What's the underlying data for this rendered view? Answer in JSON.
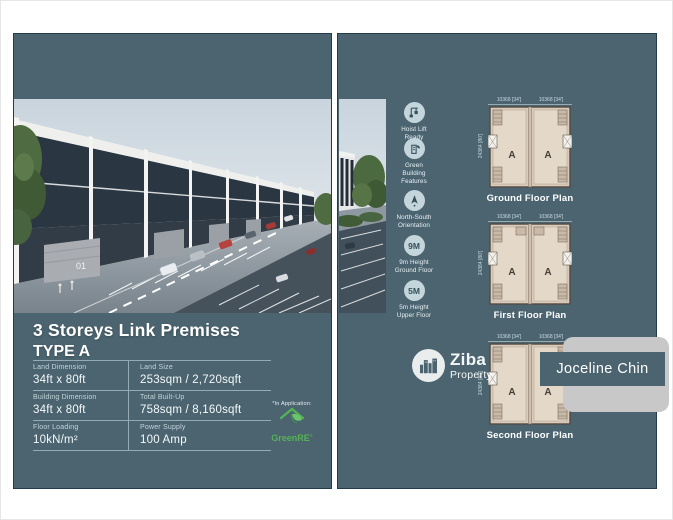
{
  "colors": {
    "panel_teal": "#4b6470",
    "plan_fill": "#dbcab8",
    "cert_green": "#55b257",
    "card_gray": "#c8c8c8"
  },
  "brand": {
    "name": "Ziba",
    "sub": "Property"
  },
  "agent": {
    "name": "Joceline Chin"
  },
  "left_panel": {
    "title_line1": "3 Storeys Link Premises",
    "title_line2": "TYPE A",
    "render_door_number": "01",
    "specs": [
      {
        "label": "Land Dimension",
        "value": "34ft x 80ft"
      },
      {
        "label": "Land Size",
        "value": "253sqm / 2,720sqft"
      },
      {
        "label": "Building Dimension",
        "value": "34ft x 80ft"
      },
      {
        "label": "Total Built-Up",
        "value": "758sqm / 8,160sqft"
      },
      {
        "label": "Floor Loading",
        "value": "10kN/m²"
      },
      {
        "label": "Power Supply",
        "value": "100 Amp"
      }
    ],
    "green_cert": {
      "note": "*In Application:",
      "name": "GreenRE"
    }
  },
  "right_panel": {
    "features": [
      {
        "icon": "hoist-lift-icon",
        "badge": "",
        "label": "Hoist Lift\nReady"
      },
      {
        "icon": "green-building-icon",
        "badge": "",
        "label": "Green\nBuilding\nFeatures"
      },
      {
        "icon": "compass-icon",
        "badge": "",
        "label": "North-South\nOrientation"
      },
      {
        "icon": "height-9m-icon",
        "badge": "9M",
        "label": "9m Height\nGround Floor"
      },
      {
        "icon": "height-5m-icon",
        "badge": "5M",
        "label": "5m Height\nUpper Floor"
      }
    ],
    "floor_plans": [
      {
        "caption": "Ground Floor Plan",
        "dim_width_left": "10368 [34']",
        "dim_width_right": "10368 [34']",
        "dim_depth": "24384 [80']",
        "unit": "A"
      },
      {
        "caption": "First Floor Plan",
        "dim_width_left": "10368 [34']",
        "dim_width_right": "10368 [34']",
        "dim_depth": "24384 [80']",
        "unit": "A"
      },
      {
        "caption": "Second Floor Plan",
        "dim_width_left": "10368 [34']",
        "dim_width_right": "10368 [34']",
        "dim_depth": "24384 [80']",
        "unit": "A"
      }
    ]
  }
}
